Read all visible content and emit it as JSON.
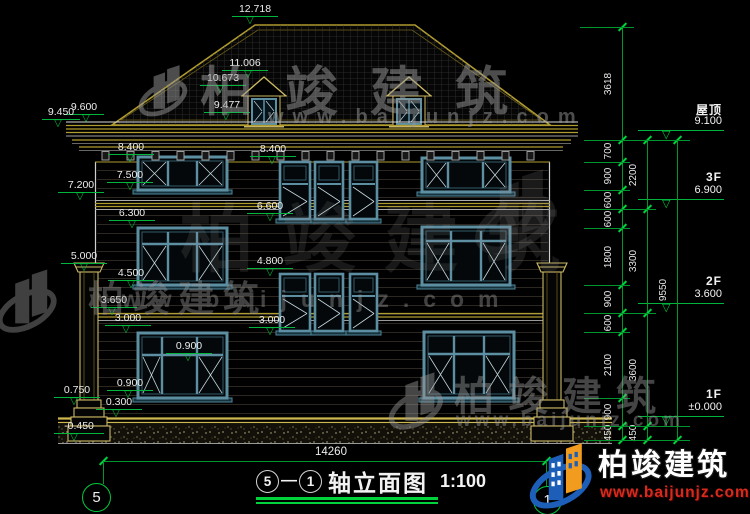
{
  "meta": {
    "brand": "柏竣建筑",
    "url": "www.baijunjz.com"
  },
  "title_bar": {
    "axis_from": "5",
    "axis_to": "1",
    "separator": "—",
    "name": "轴立面图",
    "scale": "1:100",
    "overall_dim": "14260"
  },
  "axis_bubbles": {
    "left": "5",
    "right": "1"
  },
  "levels": [
    {
      "v": "12.718",
      "x": 232,
      "w": 46,
      "ly": 16,
      "ax": 250
    },
    {
      "v": "11.006",
      "x": 222,
      "w": 46,
      "ly": 70,
      "ax": 248
    },
    {
      "v": "10.673",
      "x": 200,
      "w": 46,
      "ly": 85,
      "ax": 220
    },
    {
      "v": "9.477",
      "x": 204,
      "w": 46,
      "ly": 112,
      "ax": 226
    },
    {
      "v": "9.600",
      "x": 64,
      "w": 40,
      "ly": 114,
      "ax": 86
    },
    {
      "v": "9.450",
      "x": 42,
      "w": 38,
      "ly": 119,
      "ax": 58
    },
    {
      "v": "8.400",
      "x": 108,
      "w": 46,
      "ly": 154,
      "ax": 130
    },
    {
      "v": "7.500",
      "x": 107,
      "w": 46,
      "ly": 182,
      "ax": 130
    },
    {
      "v": "7.200",
      "x": 58,
      "w": 46,
      "ly": 192,
      "ax": 80
    },
    {
      "v": "6.300",
      "x": 109,
      "w": 46,
      "ly": 220,
      "ax": 132
    },
    {
      "v": "5.000",
      "x": 61,
      "w": 46,
      "ly": 263,
      "ax": 84
    },
    {
      "v": "4.500",
      "x": 108,
      "w": 46,
      "ly": 280,
      "ax": 131
    },
    {
      "v": "3.650",
      "x": 91,
      "w": 46,
      "ly": 307,
      "ax": 112
    },
    {
      "v": "3.000",
      "x": 105,
      "w": 46,
      "ly": 325,
      "ax": 126
    },
    {
      "v": "0.900",
      "x": 107,
      "w": 46,
      "ly": 390,
      "ax": 128
    },
    {
      "v": "0.900",
      "x": 166,
      "w": 46,
      "ly": 353,
      "ax": 188
    },
    {
      "v": "0.750",
      "x": 54,
      "w": 46,
      "ly": 397,
      "ax": 74
    },
    {
      "v": "0.300",
      "x": 96,
      "w": 46,
      "ly": 409,
      "ax": 116
    },
    {
      "v": "-0.450",
      "x": 54,
      "w": 50,
      "ly": 433,
      "ax": 74
    },
    {
      "v": "8.400",
      "x": 250,
      "w": 46,
      "ly": 156,
      "ax": 272
    },
    {
      "v": "6.600",
      "x": 247,
      "w": 46,
      "ly": 213,
      "ax": 270
    },
    {
      "v": "4.800",
      "x": 247,
      "w": 46,
      "ly": 268,
      "ax": 270
    },
    {
      "v": "3.000",
      "x": 249,
      "w": 46,
      "ly": 327,
      "ax": 270
    }
  ],
  "floors": [
    {
      "f": "屋顶",
      "v": "9.100",
      "ly": 130
    },
    {
      "f": "3F",
      "v": "6.900",
      "ly": 199
    },
    {
      "f": "2F",
      "v": "3.600",
      "ly": 303
    },
    {
      "f": "1F",
      "v": "±0.000",
      "ly": 416
    }
  ],
  "chains": [
    {
      "x": 622,
      "segs": [
        {
          "t": "3618",
          "a": 27,
          "b": 140
        },
        {
          "t": "700",
          "a": 140,
          "b": 162
        },
        {
          "t": "900",
          "a": 162,
          "b": 190
        },
        {
          "t": "600",
          "a": 190,
          "b": 209
        },
        {
          "t": "600",
          "a": 209,
          "b": 228
        },
        {
          "t": "1800",
          "a": 228,
          "b": 285
        },
        {
          "t": "900",
          "a": 285,
          "b": 313
        },
        {
          "t": "600",
          "a": 313,
          "b": 332
        },
        {
          "t": "2100",
          "a": 332,
          "b": 398
        },
        {
          "t": "900",
          "a": 398,
          "b": 426
        },
        {
          "t": "450",
          "a": 426,
          "b": 440
        }
      ]
    },
    {
      "x": 647,
      "segs": [
        {
          "t": "2200",
          "a": 140,
          "b": 209
        },
        {
          "t": "3300",
          "a": 209,
          "b": 313
        },
        {
          "t": "3600",
          "a": 313,
          "b": 426
        },
        {
          "t": "450",
          "a": 426,
          "b": 440
        }
      ]
    },
    {
      "x": 677,
      "segs": [
        {
          "t": "9550",
          "a": 140,
          "b": 440
        }
      ]
    }
  ],
  "connectors": [
    {
      "x1": 580,
      "y": 27,
      "x2": 634
    },
    {
      "x1": 584,
      "y": 140,
      "x2": 690
    },
    {
      "x1": 584,
      "y": 162,
      "x2": 630
    },
    {
      "x1": 584,
      "y": 190,
      "x2": 630
    },
    {
      "x1": 584,
      "y": 209,
      "x2": 656
    },
    {
      "x1": 584,
      "y": 228,
      "x2": 630
    },
    {
      "x1": 584,
      "y": 285,
      "x2": 630
    },
    {
      "x1": 584,
      "y": 313,
      "x2": 656
    },
    {
      "x1": 584,
      "y": 332,
      "x2": 630
    },
    {
      "x1": 584,
      "y": 398,
      "x2": 630
    },
    {
      "x1": 584,
      "y": 426,
      "x2": 690
    },
    {
      "x1": 584,
      "y": 440,
      "x2": 690
    }
  ],
  "windows": {
    "big": [
      {
        "x": 138,
        "y": 157,
        "w": 89,
        "h": 33,
        "cols": [
          168,
          197
        ],
        "transom": 0
      },
      {
        "x": 422,
        "y": 158,
        "w": 88,
        "h": 34,
        "cols": [
          448,
          483
        ],
        "transom": 0
      },
      {
        "x": 138,
        "y": 228,
        "w": 89,
        "h": 57,
        "cols": [
          168,
          197
        ],
        "transom": 244
      },
      {
        "x": 422,
        "y": 227,
        "w": 88,
        "h": 58,
        "cols": [
          451,
          481
        ],
        "transom": 241
      },
      {
        "x": 138,
        "y": 333,
        "w": 89,
        "h": 65,
        "cols": [
          162,
          197
        ],
        "transom": 355
      },
      {
        "x": 424,
        "y": 332,
        "w": 90,
        "h": 66,
        "cols": [
          454,
          484
        ],
        "transom": 354
      }
    ],
    "narrow": [
      {
        "x": 280,
        "y": 162,
        "w": 30,
        "h": 57,
        "mid": 184
      },
      {
        "x": 315,
        "y": 162,
        "w": 28,
        "h": 57,
        "mid": 184
      },
      {
        "x": 350,
        "y": 162,
        "w": 27,
        "h": 57,
        "mid": 184
      },
      {
        "x": 280,
        "y": 274,
        "w": 30,
        "h": 57,
        "mid": 296
      },
      {
        "x": 315,
        "y": 274,
        "w": 28,
        "h": 57,
        "mid": 296
      },
      {
        "x": 350,
        "y": 274,
        "w": 27,
        "h": 57,
        "mid": 296
      }
    ]
  }
}
